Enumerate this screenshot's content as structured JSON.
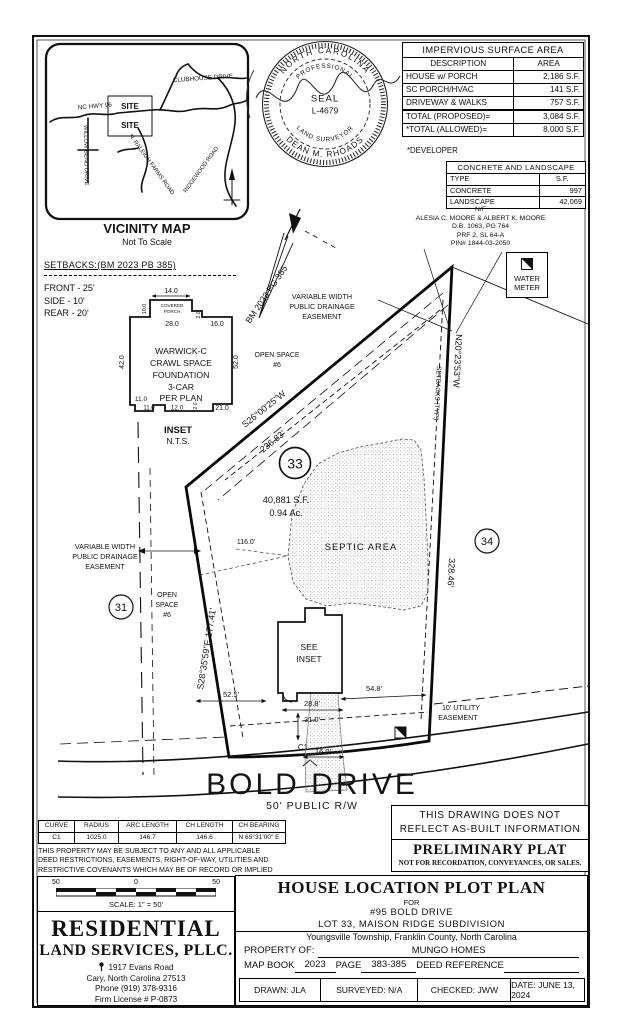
{
  "vicinity": {
    "title": "VICINITY MAP",
    "subtitle": "Not To Scale",
    "site": "SITE",
    "roads": {
      "hwy": "NC HWY 96",
      "clubhouse": "CLUBHOUSE DRIVE",
      "willow": "WILLOW BEND DRIVE",
      "raleigh_farms": "N. RALEIGH FARMS ROAD",
      "ridgewood": "RIDGEWOOD ROAD"
    }
  },
  "seal": {
    "outer_top": "NORTH CAROLINA",
    "outer_bottom": "DEAN M. RHOADS",
    "inner_top": "PROFESSIONAL",
    "inner_bottom": "LAND SURVEYOR",
    "center1": "SEAL",
    "center2": "L-4679"
  },
  "impervious": {
    "title": "IMPERVIOUS SURFACE AREA",
    "col_desc": "DESCRIPTION",
    "col_area": "AREA",
    "rows": [
      {
        "desc": "HOUSE w/ PORCH",
        "area": "2,186 S.F."
      },
      {
        "desc": "SC PORCH/HVAC",
        "area": "141 S.F."
      },
      {
        "desc": "DRIVEWAY & WALKS",
        "area": "757 S.F."
      }
    ],
    "total_rows": [
      {
        "desc": "TOTAL (PROPOSED)=",
        "area": "3,084 S.F."
      },
      {
        "desc": "*TOTAL (ALLOWED)=",
        "area": "8,000 S.F."
      }
    ],
    "footnote": "*DEVELOPER"
  },
  "concrete": {
    "title": "CONCRETE AND LANDSCAPE",
    "col_type": "TYPE",
    "col_sf": "S.F.",
    "rows": [
      {
        "type": "CONCRETE",
        "sf": "997"
      },
      {
        "type": "LANDSCAPE",
        "sf": "42,069"
      }
    ]
  },
  "adjoiner": {
    "l1": "N/F",
    "l2": "ALESIA C. MOORE & ALBERT K. MOORE",
    "l3": "D.B. 1063, PG 764",
    "l4": "PRF 2, SL 64-A",
    "l5": "PIN# 1844-03-2050"
  },
  "legend": {
    "water1": "WATER",
    "water2": "METER"
  },
  "setbacks": {
    "title": "SETBACKS:(BM 2023 PB 385)",
    "front": "FRONT - 25'",
    "side": "SIDE - 10'",
    "rear": "REAR - 20'"
  },
  "inset": {
    "house1": "WARWICK-C",
    "house2": "CRAWL SPACE",
    "house3": "FOUNDATION",
    "house4": "3-CAR",
    "house5": "PER PLAN",
    "porch1": "COVERED",
    "porch2": "PORCH",
    "d14": "14.0",
    "d10": "10.0",
    "d28": "28.0",
    "d2a": "2.0",
    "d16": "16.0",
    "d42": "42.0",
    "d52": "52.0",
    "d11a": "11.0",
    "d11b": "11.0",
    "d12": "12.0",
    "d2b": "2.0",
    "d21": "21.0",
    "caption1": "INSET",
    "caption2": "N.T.S."
  },
  "plot": {
    "bm": "BM 2023 PG 385",
    "bearing_top": "S26°00'25\"W",
    "dist_top": "236.83'",
    "bearing_right": "N20°23'53\"W",
    "dist_right": "328.46'",
    "bearing_left": "S28°35'59\"E  177.41'",
    "setbacks_typ": "SETBACKS (TYP.)",
    "lot_number": "33",
    "lot31": "31",
    "lot34": "34",
    "area_sf": "40,881 S.F.",
    "area_ac": "0.94 Ac.",
    "septic": "SEPTIC AREA",
    "open_top1": "OPEN SPACE",
    "open_top2": "#6",
    "open_left1": "OPEN",
    "open_left2": "SPACE",
    "open_left3": "#6",
    "ease_top1": "VARIABLE WIDTH",
    "ease_top2": "PUBLIC DRAINAGE",
    "ease_top3": "EASEMENT",
    "ease_left1": "VARIABLE WIDTH",
    "ease_left2": "PUBLIC DRAINAGE",
    "ease_left3": "EASEMENT",
    "see_inset1": "SEE",
    "see_inset2": "INSET",
    "d525": "52.5'",
    "d288": "28.8'",
    "d548": "54.8'",
    "d310": "31.0'",
    "d160": "16.0'",
    "d116": "116.0'",
    "c1": "C1",
    "util1": "10' UTILITY",
    "util2": "EASEMENT"
  },
  "road": {
    "name": "BOLD DRIVE",
    "rw": "50' PUBLIC R/W"
  },
  "curve_table": {
    "headers": [
      "CURVE",
      "RADIUS",
      "ARC LENGTH",
      "CH LENGTH",
      "CH BEARING"
    ],
    "row": [
      "C1",
      "1025.0",
      "146.7",
      "146.6",
      "N 65°31'00\" E"
    ]
  },
  "notes": {
    "property1": "THIS PROPERTY MAY BE SUBJECT TO ANY AND ALL APPLICABLE",
    "property2": "DEED RESTRICTIONS, EASEMENTS, RIGHT-OF-WAY, UTILITIES AND",
    "property3": "RESTRICTIVE COVENANTS WHICH MAY BE OF RECORD OR IMPLIED",
    "asbuilt1": "THIS DRAWING DOES NOT",
    "asbuilt2": "REFLECT AS-BUILT INFORMATION",
    "prelim_title": "PRELIMINARY PLAT",
    "prelim_sub": "NOT FOR RECORDATION, CONVEYANCES, OR SALES."
  },
  "scalebar": {
    "left": "50",
    "center": "0",
    "right": "50",
    "label": "SCALE: 1\" = 50'"
  },
  "firm": {
    "name1": "RESIDENTIAL",
    "name2": "LAND SERVICES, PLLC.",
    "addr1": "1917 Evans Road",
    "addr2": "Cary, North Carolina 27513",
    "addr3": "Phone (919) 378-9316",
    "addr4": "Firm License # P-0873"
  },
  "title_block": {
    "title": "HOUSE LOCATION PLOT PLAN",
    "for": "FOR",
    "address": "#95 BOLD DRIVE",
    "lot": "LOT 33, MAISON RIDGE SUBDIVISION",
    "township": "Youngsville Township, Franklin County, North Carolina",
    "property_of": "PROPERTY OF:",
    "owner": "MUNGO HOMES",
    "map_book_label": "MAP BOOK",
    "map_book": "2023",
    "page_label": "PAGE",
    "page": "383-385",
    "deed_label": "DEED REFERENCE",
    "drawn": "DRAWN: JLA",
    "surveyed": "SURVEYED: N/A",
    "checked": "CHECKED: JWW",
    "date": "DATE: JUNE 13, 2024"
  }
}
